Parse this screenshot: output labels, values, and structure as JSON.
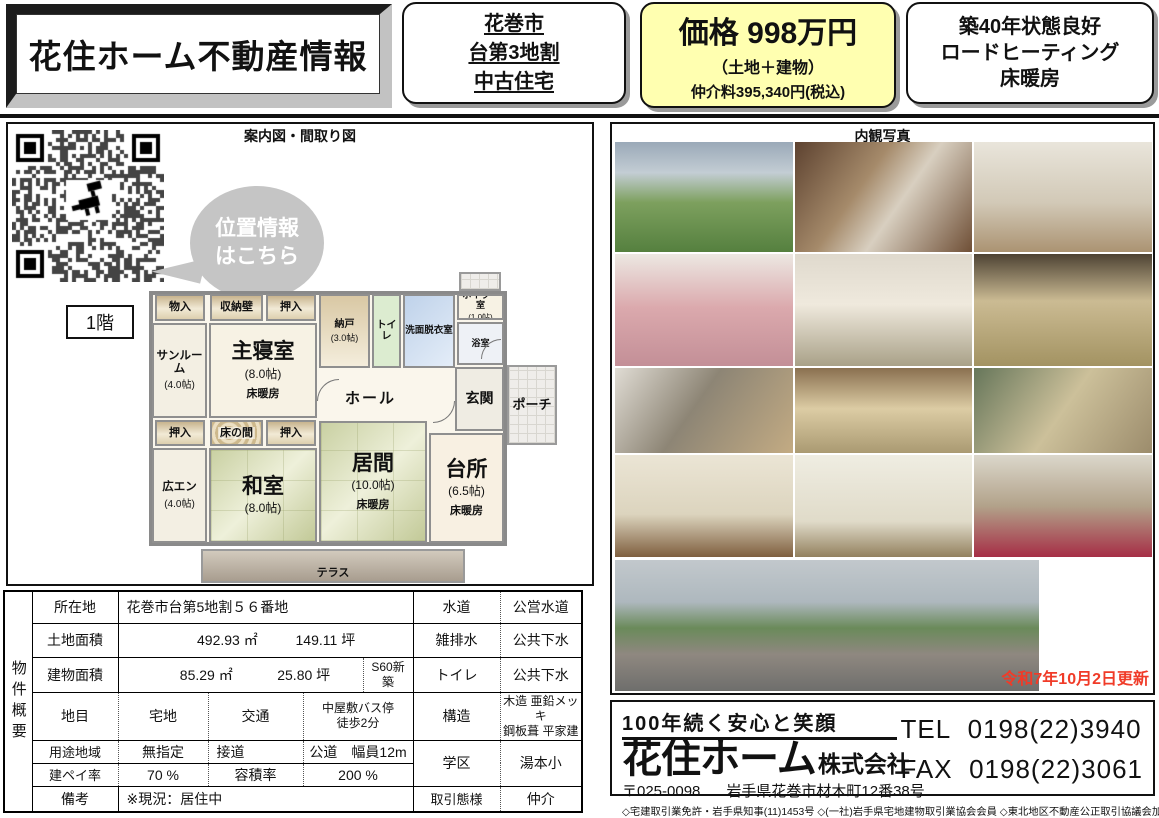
{
  "colors": {
    "price_box_bg": "#ffffb0",
    "update_text": "#f03b28",
    "bubble_gray": "#c5c5c5",
    "tatami_green": "#c9d0a2",
    "wall_gray": "#8a8a8a"
  },
  "header": {
    "title": "花住ホーム不動産情報",
    "location_box": {
      "lines": [
        "花巻市",
        "台第3地割",
        "中古住宅"
      ]
    },
    "price_box": {
      "price": "価格 998万円",
      "sub": "（土地＋建物）",
      "fee": "仲介料395,340円(税込)"
    },
    "feature_box": {
      "lines": [
        "築40年状態良好",
        "ロードヒーティング",
        "床暖房"
      ]
    }
  },
  "left_panel": {
    "title": "案内図・間取り図",
    "qr": "qr-code-location-map",
    "bubble_lines": [
      "位置情報",
      "はこちら"
    ],
    "floor_label": "1階",
    "floorplan": {
      "rooms": {
        "monoiri": {
          "label": "物入"
        },
        "shuno": {
          "label": "収納壁"
        },
        "oshiire1": {
          "label": "押入"
        },
        "nando": {
          "label": "納戸",
          "size": "(3.0帖)"
        },
        "toilet": {
          "label": "トイレ"
        },
        "senmen": {
          "label": "洗面脱衣室"
        },
        "boiler": {
          "label": "ボイラー室",
          "size": "(1.0帖)"
        },
        "bath": {
          "label": "浴室"
        },
        "sunroom": {
          "label": "サンルーム",
          "size": "(4.0帖)"
        },
        "master": {
          "label": "主寝室",
          "size": "(8.0帖)",
          "note": "床暖房"
        },
        "hall": {
          "label": "ホール"
        },
        "genkan": {
          "label": "玄関"
        },
        "porch": {
          "label": "ポーチ"
        },
        "oshiire2": {
          "label": "押入"
        },
        "tokonoma": {
          "label": "床の間"
        },
        "oshiire3": {
          "label": "押入"
        },
        "hiroen": {
          "label": "広エン",
          "size": "(4.0帖)"
        },
        "washitsu": {
          "label": "和室",
          "size": "(8.0帖)"
        },
        "ima": {
          "label": "居間",
          "size": "(10.0帖)",
          "note": "床暖房"
        },
        "daidokoro": {
          "label": "台所",
          "size": "(6.5帖)",
          "note": "床暖房"
        },
        "terrace": {
          "label": "テラス"
        }
      }
    }
  },
  "right_panel": {
    "title": "内観写真",
    "photos": [
      "exterior-garden",
      "entry-hall",
      "washroom",
      "bathroom-pink-tub",
      "toilet",
      "tatami-room",
      "kitchen",
      "living-tatami",
      "tatami-green-wall",
      "sunroom-curtains",
      "lace-curtain-room",
      "bedroom-red-carpet"
    ],
    "big_photo": "exterior-street-view",
    "updated": "令和7年10月2日更新"
  },
  "table": {
    "section_label": "物件概要",
    "rows": {
      "location": {
        "label": "所在地",
        "value": "花巻市台第5地割５６番地"
      },
      "land": {
        "label": "土地面積",
        "m2": "492.93",
        "m2_unit": "㎡",
        "tsubo": "149.11",
        "tsubo_unit": "坪"
      },
      "building": {
        "label": "建物面積",
        "m2": "85.29",
        "m2_unit": "㎡",
        "tsubo": "25.80",
        "tsubo_unit": "坪",
        "built": "S60新築"
      },
      "landcat": {
        "label": "地目",
        "value": "宅地",
        "t_label": "交通",
        "t_line1": "中屋敷バス停",
        "t_line2": "徒歩2分"
      },
      "zoning": {
        "label": "用途地域",
        "value": "無指定",
        "s_label": "接道",
        "s_value": "公道　幅員12m"
      },
      "bcr": {
        "label": "建ペイ率",
        "value": "70 %",
        "far_label": "容積率",
        "far_value": "200 %"
      },
      "notes": {
        "label": "備考",
        "value": "※現況：居住中"
      },
      "water": {
        "label": "水道",
        "value": "公営水道"
      },
      "drain": {
        "label": "雑排水",
        "value": "公共下水"
      },
      "toilet": {
        "label": "トイレ",
        "value": "公共下水"
      },
      "structure": {
        "label": "構造",
        "line1": "木造 亜鉛メッキ",
        "line2": "鋼板葺 平家建"
      },
      "school": {
        "label": "学区",
        "value": "湯本小"
      },
      "deal": {
        "label": "取引態様",
        "value": "仲介"
      }
    }
  },
  "company": {
    "slogan": "100年続く安心と笑顔",
    "name_main": "花住ホーム",
    "name_suffix": "株式会社",
    "postal": "〒025-0098",
    "address": "岩手県花巻市材木町12番38号",
    "licenses": "◇宅建取引業免許・岩手県知事(11)1453号 ◇(一社)岩手県宅地建物取引業協会会員 ◇東北地区不動産公正取引協議会加盟",
    "tel_label": "TEL",
    "tel": "0198(22)3940",
    "fax_label": "FAX",
    "fax": "0198(22)3061"
  }
}
